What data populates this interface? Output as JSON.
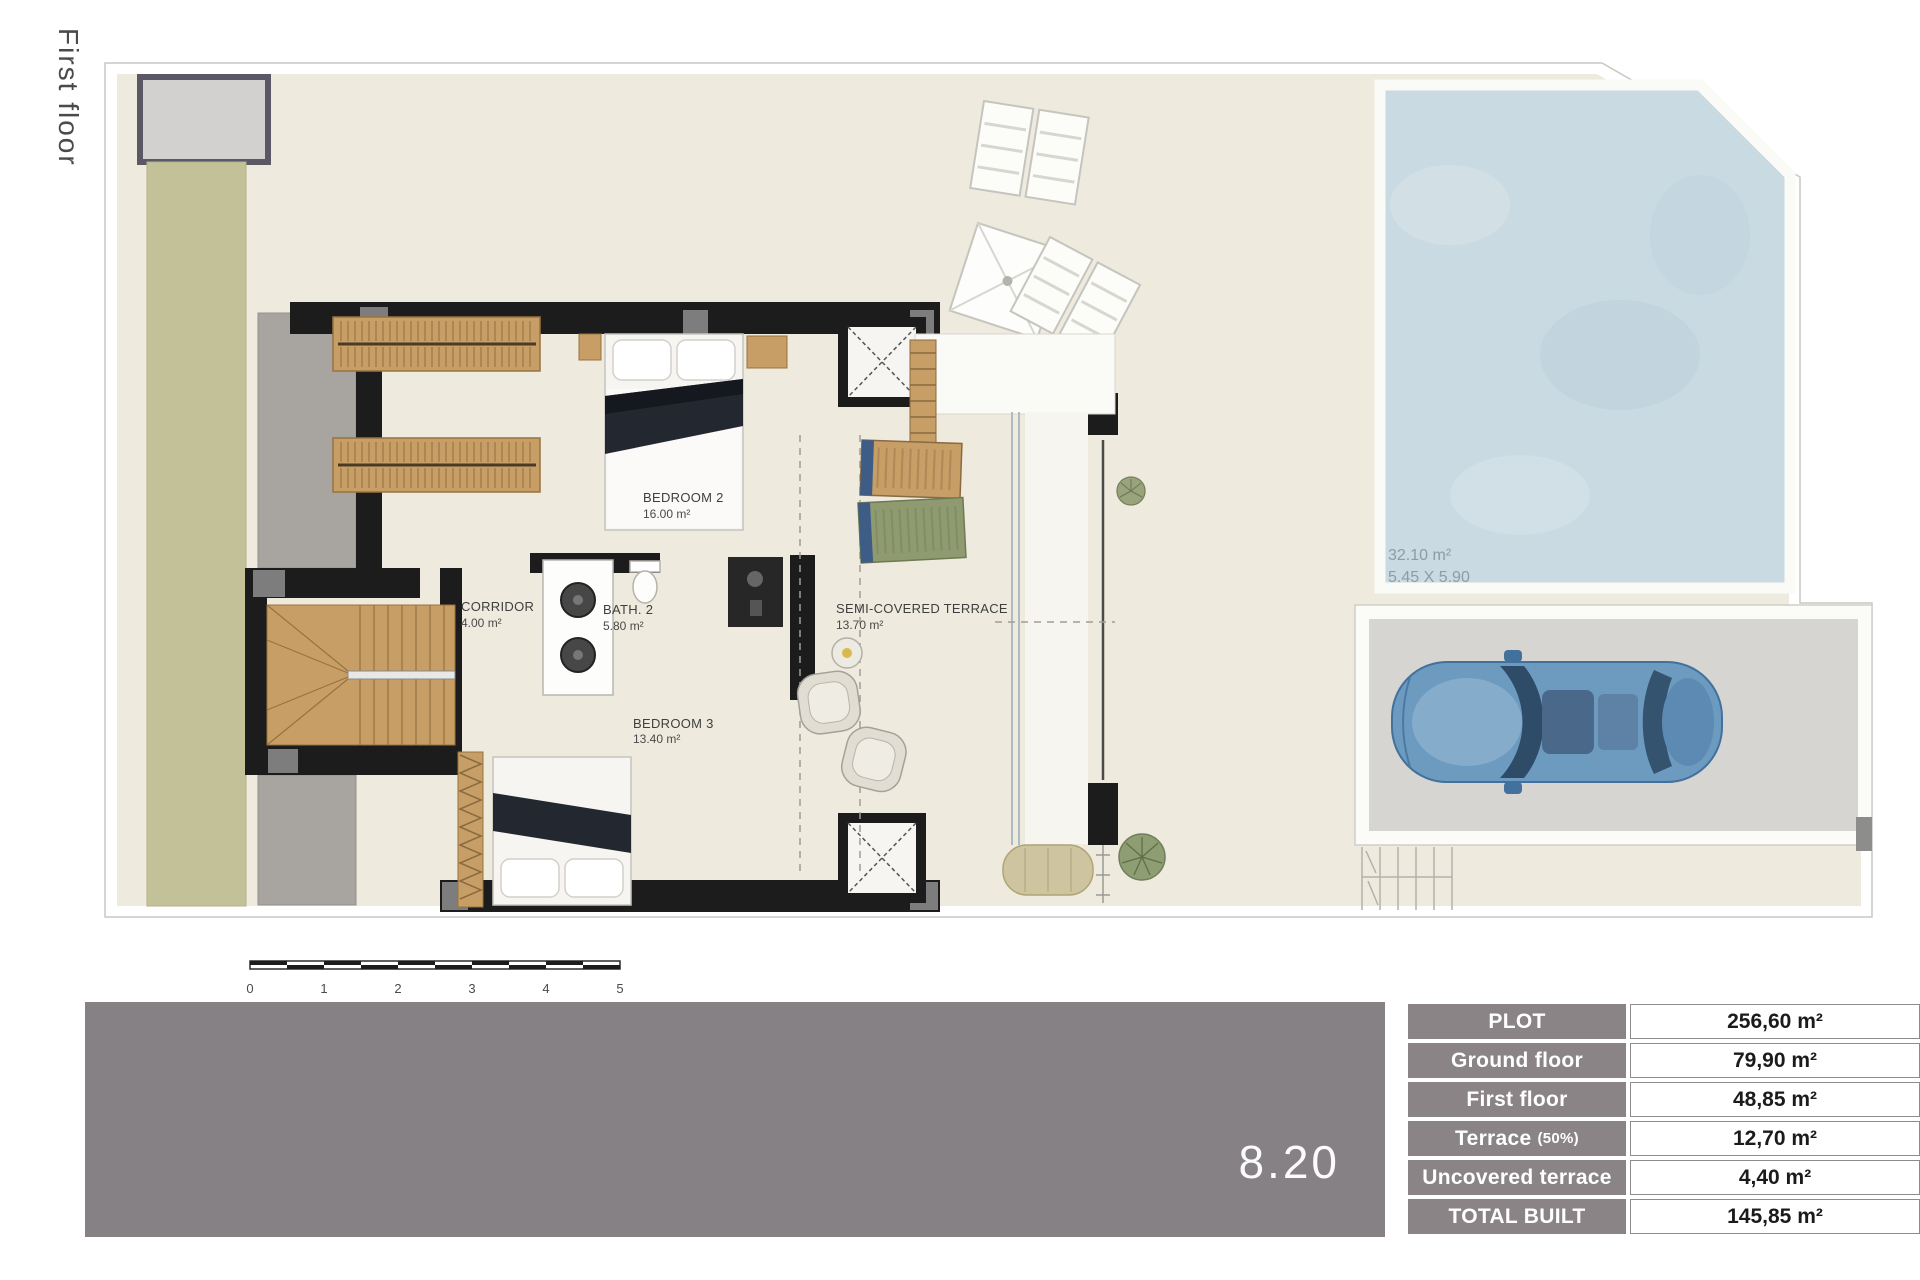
{
  "page": {
    "floor_label": "First floor"
  },
  "plan": {
    "rooms": [
      {
        "name": "BEDROOM 2",
        "area": "16.00 m²"
      },
      {
        "name": "CORRIDOR",
        "area": "4.00 m²"
      },
      {
        "name": "BATH. 2",
        "area": "5.80 m²"
      },
      {
        "name": "BEDROOM 3",
        "area": "13.40 m²"
      },
      {
        "name": "SEMI-COVERED TERRACE",
        "area": "13.70 m²"
      }
    ],
    "pool": {
      "area": "32.10 m²",
      "dimensions": "5.45 X 5.90"
    },
    "scale_bar": {
      "labels": [
        "0",
        "1",
        "2",
        "3",
        "4",
        "5"
      ]
    }
  },
  "footer": {
    "plan_number": "8.20"
  },
  "summary_table": {
    "rows": [
      {
        "label": "PLOT",
        "value": "256,60 m²"
      },
      {
        "label": "Ground floor",
        "value": "79,90 m²"
      },
      {
        "label": "First floor",
        "value": "48,85 m²"
      },
      {
        "label": "Terrace",
        "suffix": "(50%)",
        "value": "12,70 m²"
      },
      {
        "label": "Uncovered terrace",
        "value": "4,40 m²"
      },
      {
        "label": "TOTAL BUILT",
        "value": "145,85 m²"
      }
    ]
  },
  "colors": {
    "footer_bar": "#868184",
    "table_header": "#8a8487",
    "wall_black": "#1c1c1c",
    "wood": "#c79e66",
    "pool_water": "#c9dae2",
    "green_border": "#c2c197",
    "gravel": "#a8a5a0",
    "interior_floor": "#efeade",
    "parking_gray": "#d6d5d1",
    "car_blue": "#6d9abf"
  }
}
